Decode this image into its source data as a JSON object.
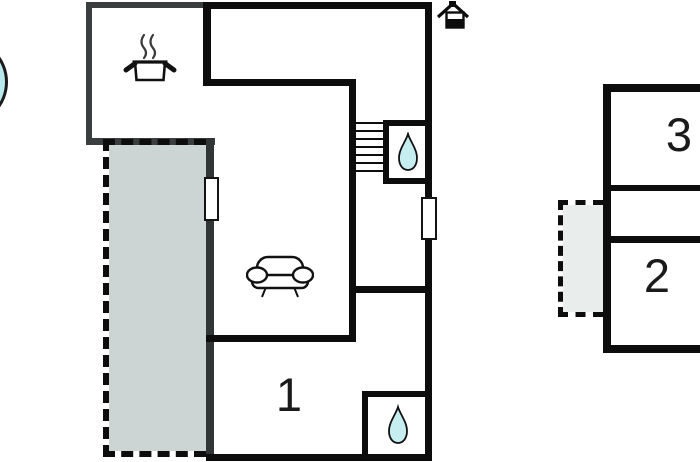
{
  "canvas": {
    "width": 700,
    "height": 462,
    "background": "#ffffff"
  },
  "colors": {
    "bg": "#ffffff",
    "wall_black": "#0d0d0d",
    "wall_gray": "#3b3e3e",
    "terrace_fill": "#cdd4d4",
    "balcony_fill": "#e9edec",
    "water_fill": "#c6edf0",
    "pool_fill": "#b9e9ec",
    "label_color": "#1a1a1a"
  },
  "ground_floor": {
    "room_labels": {
      "room1": "1"
    },
    "icons": [
      "north-house-icon",
      "cooking-pot-icon",
      "sofa-icon",
      "stairs-icon",
      "water-drop-icon-upper-bathroom",
      "water-drop-icon-lower-bathroom",
      "pool-icon",
      "window-marker-west",
      "window-marker-east",
      "terrace-dashed-area"
    ]
  },
  "upper_floor": {
    "room_labels": {
      "room2": "2",
      "room3": "3"
    },
    "icons": [
      "balcony-dashed-area"
    ]
  }
}
